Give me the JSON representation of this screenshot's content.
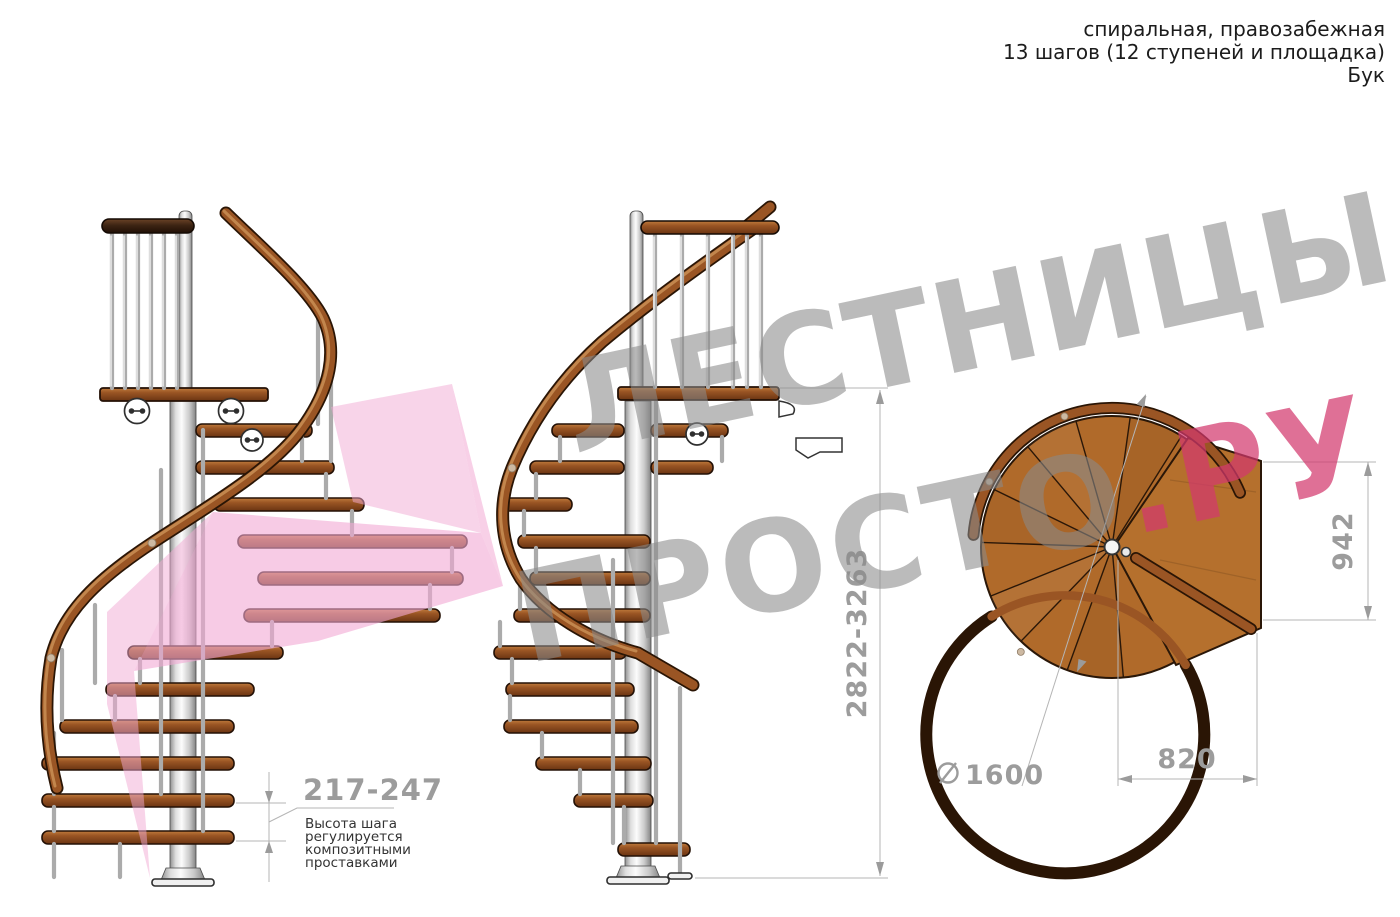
{
  "header": {
    "line1": "спиральная, правозабежная",
    "line2": "13 шагов (12 ступеней и площадка)",
    "line3": "Бук"
  },
  "dimensions": {
    "step_height": "217-247",
    "step_note_lines": [
      "Высота шага",
      "регулируется",
      "композитными",
      "проставками"
    ],
    "total_height": "2822-3263",
    "landing_depth": "942",
    "landing_width": "820",
    "diameter_symbol": "⌀",
    "diameter": "1600"
  },
  "watermark": {
    "line1": "ЛЕСТНИЦЫ",
    "line2_gray": "ПРОСТО",
    "line2_pink": ".РУ"
  },
  "colors": {
    "wood_light": "#b06a2a",
    "wood_mid": "#9a5524",
    "wood_dark": "#6b3412",
    "outline": "#2a1708",
    "dim_gray": "#9c9c9c",
    "note_text": "#333333",
    "header_text": "#1c1c1c",
    "watermark_pink": "#d3396d",
    "arrow_pink": "#f2a9d4"
  }
}
